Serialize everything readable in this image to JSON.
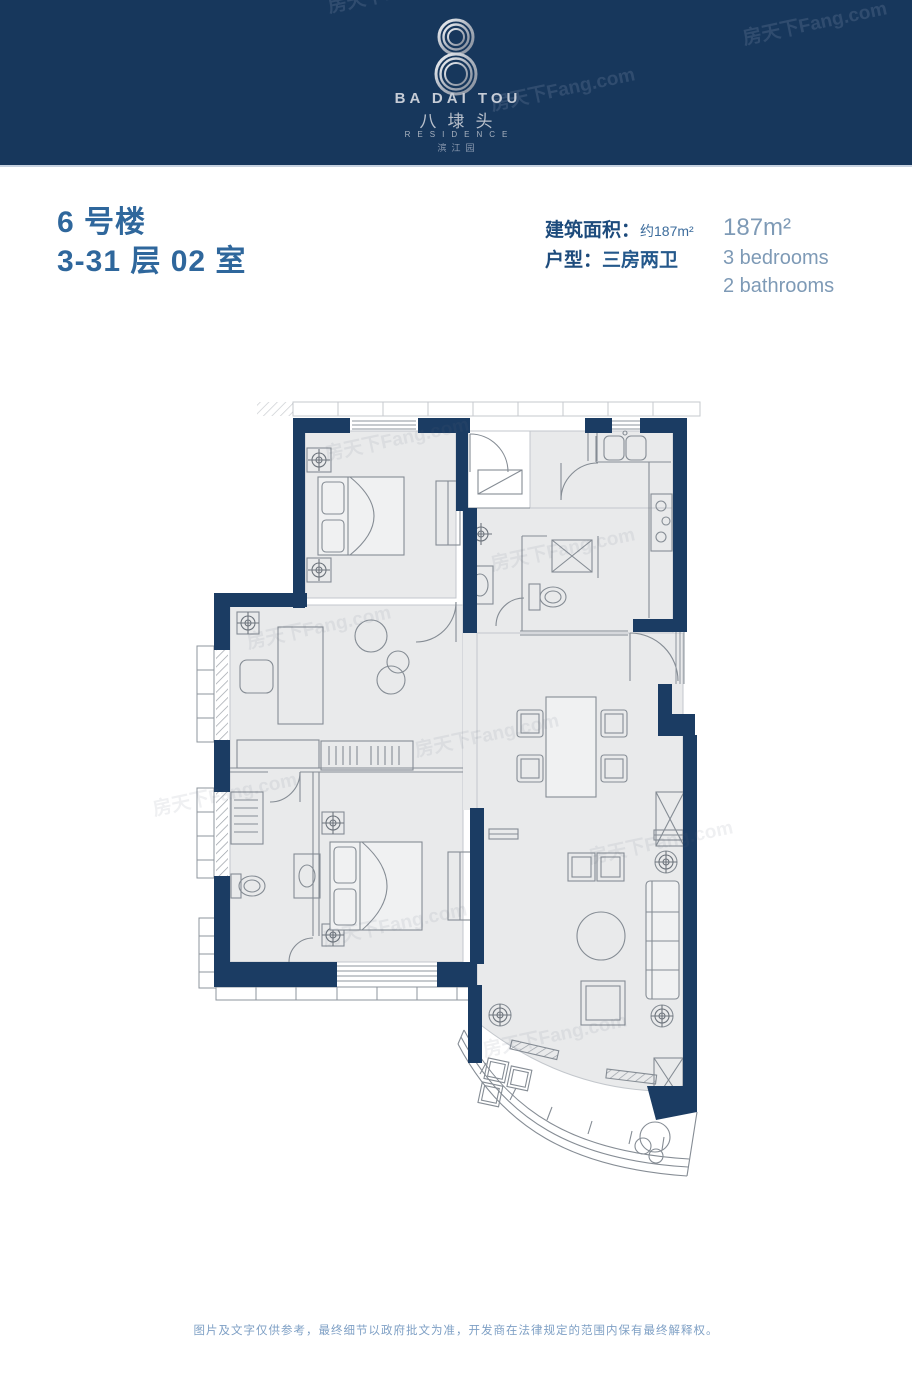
{
  "watermark": {
    "text": "房天下Fang.com"
  },
  "header": {
    "logo": {
      "en": "BA DAI TOU",
      "cn": "八埭头",
      "residence": "RESIDENCE",
      "sub": "滨江园"
    }
  },
  "unit": {
    "building": "6 号楼",
    "floor_room": "3-31 层 02 室",
    "area_label": "建筑面积：",
    "area_value": "约187m²",
    "type_label": "户型：",
    "type_value": "三房两卫",
    "area_en": "187m²",
    "bedrooms": "3 bedrooms",
    "bathrooms": "2 bathrooms"
  },
  "footer": {
    "disclaimer": "图片及文字仅供参考，最终细节以政府批文为准，开发商在法律规定的范围内保有最终解释权。"
  },
  "colors": {
    "header_bg": "#17375c",
    "wall_navy": "#1b3c63",
    "title_blue": "#2f679c",
    "label_navy": "#1d4b7c",
    "en_blue": "#7e9ab6",
    "floor_fill": "#e9eaeb",
    "footer_text": "#7fa0c5"
  }
}
